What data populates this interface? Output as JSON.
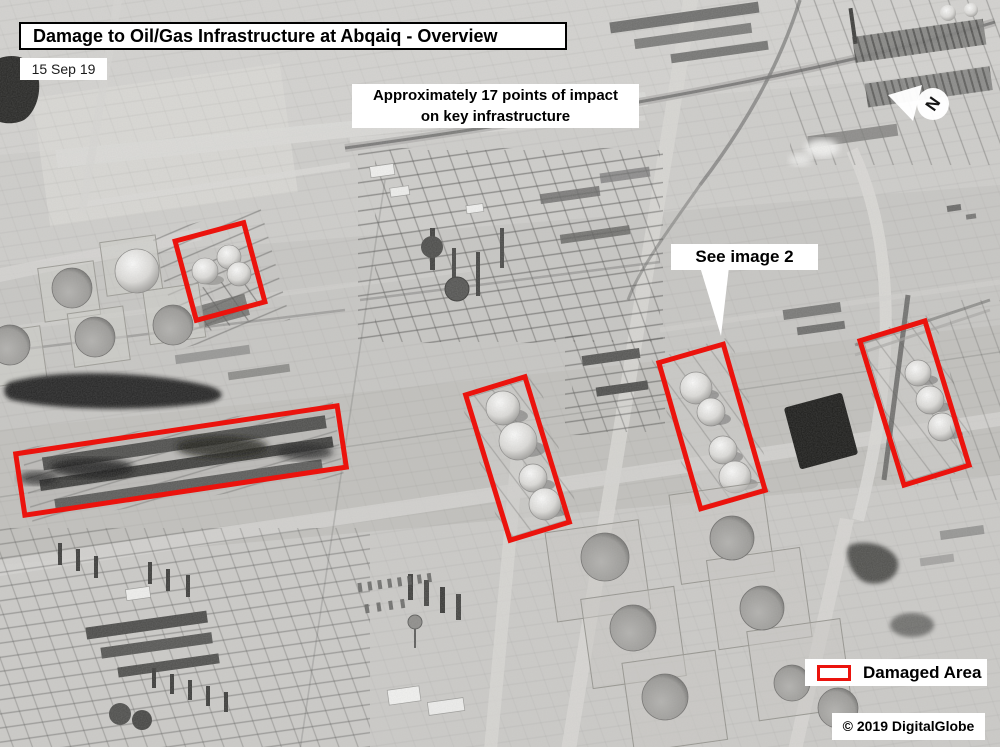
{
  "colors": {
    "accent_red": "#eb130d"
  },
  "header": {
    "title": "Damage to Oil/Gas Infrastructure at Abqaiq - Overview",
    "date": "15 Sep 19"
  },
  "annotations": {
    "impact_note": {
      "line1": "Approximately 17 points of impact",
      "line2": "on key infrastructure"
    },
    "see_image": {
      "label": "See image 2"
    }
  },
  "compass": {
    "label": "N"
  },
  "legend": {
    "label": "Damaged Area"
  },
  "credit": {
    "text": "© 2019 DigitalGlobe"
  }
}
